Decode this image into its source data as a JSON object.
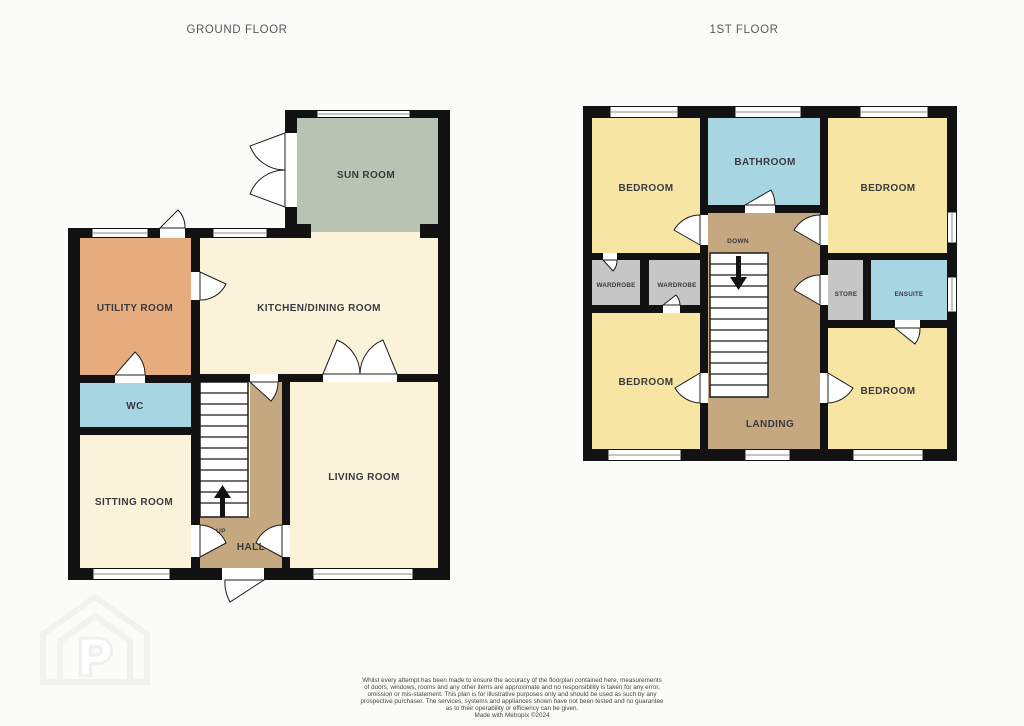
{
  "titles": {
    "ground_floor": "GROUND FLOOR",
    "first_floor": "1ST FLOOR"
  },
  "ground_floor": {
    "rooms": {
      "sun_room": "SUN ROOM",
      "utility_room": "UTILITY ROOM",
      "kitchen_dining_room": "KITCHEN/DINING ROOM",
      "wc": "WC",
      "sitting_room": "SITTING ROOM",
      "living_room": "LIVING ROOM",
      "hall": "HALL"
    },
    "stairs_label": "UP"
  },
  "first_floor": {
    "rooms": {
      "bedroom_top_left": "BEDROOM",
      "bathroom": "BATHROOM",
      "bedroom_top_right": "BEDROOM",
      "wardrobe_left": "WARDROBE",
      "wardrobe_right": "WARDROBE",
      "store": "STORE",
      "ensuite": "ENSUITE",
      "bedroom_bottom_left": "BEDROOM",
      "bedroom_bottom_right": "BEDROOM",
      "landing": "LANDING"
    },
    "stairs_label": "DOWN"
  },
  "watermark": {
    "letter": "P"
  },
  "disclaimer": {
    "lines": [
      "Whilst every attempt has been made to ensure the accuracy of the floorplan contained here, measurements",
      "of doors, windows, rooms and any other items are approximate and no responsibility is taken for any error,",
      "omission or mis-statement. This plan is for illustrative purposes only and should be used as such by any",
      "prospective purchaser. The services, systems and appliances shown have not been tested and no guarantee",
      "as to their operability or efficiency can be given.",
      "Made with Metropix ©2024"
    ]
  },
  "colors": {
    "wall": "#121212",
    "cream": "#faf3da",
    "tan": "#c5a87f",
    "orange": "#e7ac7d",
    "light_blue": "#a8d5e2",
    "gray_green": "#b9c3b4",
    "yellow": "#f6e5a3",
    "gray": "#c6c6c6",
    "stairs_white": "#ffffff",
    "title_text": "#57585a",
    "label_text": "#3a3b40",
    "watermark_gray": "#f1f1ef",
    "background": "#fbfbf9"
  }
}
